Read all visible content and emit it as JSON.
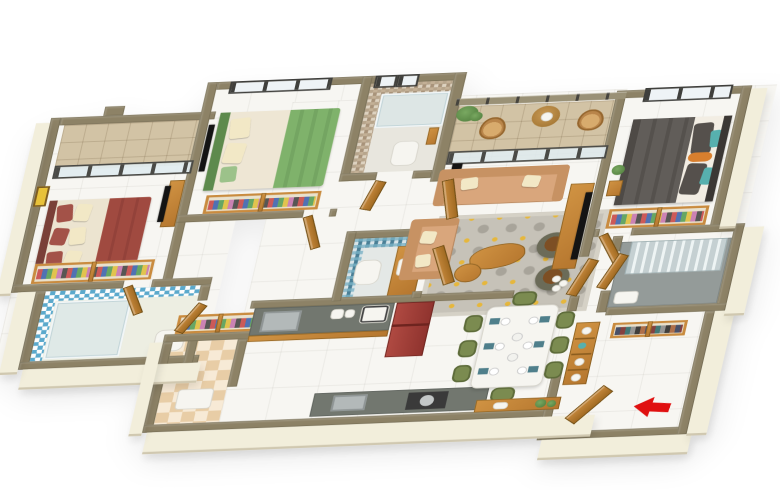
{
  "scene": {
    "type": "3d-floorplan-isometric-render",
    "description": "Photorealistic 3D rendered top-down isometric floor plan of a 3-bedroom apartment on a white background",
    "background": "#ffffff"
  },
  "palette": {
    "wall_top": "#8d8266",
    "wall_face": "#f2eedb",
    "marble": "#f7f6f2",
    "stone_tan": "#d2c3a5",
    "wood": "#c98b3f",
    "wood_dark": "#b5762e",
    "sofa_tan": "#d9a67c",
    "pillow_cream": "#f2e8c6",
    "bed1_maroon": "#a04a40",
    "bed2_green": "#7fb26b",
    "bed3_gray": "#5f5b57",
    "teal_accent": "#57b0ae",
    "orange_accent": "#d97f2e",
    "dining_chair_olive": "#7b8b50",
    "counter_gray": "#72776f",
    "fridge_red": "#8f332e",
    "tile_blue": "#5ba9cc",
    "mosaic_beige": "#c3b096",
    "mosaic_blue": "#6fa8bc",
    "rug_gray": "#c6c2b8",
    "rug_yellow": "#e6b73c",
    "glass": "#e9eff1",
    "arrow_red": "#e01010",
    "utility_tile": "#e8cda6"
  },
  "rooms": [
    {
      "name": "balcony-1",
      "floor": "stone tiles",
      "features": [
        "sliding glass door",
        "parapet walls"
      ]
    },
    {
      "name": "bedroom-1",
      "floor": "marble",
      "furniture": [
        "double bed with maroon throw",
        "maroon and cream pillows",
        "wardrobe",
        "tv unit",
        "yellow wall art"
      ]
    },
    {
      "name": "bathroom-1",
      "floor": "ceramic",
      "features": [
        "blue patterned wall tiles",
        "glass shower",
        "toilet",
        "wooden door"
      ]
    },
    {
      "name": "hallway-west",
      "floor": "marble",
      "furniture": [
        "wardrobe shoe units"
      ]
    },
    {
      "name": "bedroom-2",
      "floor": "marble",
      "furniture": [
        "double bed with green blanket",
        "green headboard",
        "wardrobe",
        "tv"
      ],
      "features": [
        "north window"
      ]
    },
    {
      "name": "bathroom-2",
      "floor": "ceramic",
      "features": [
        "beige mosaic tiles",
        "glass shower",
        "toilet",
        "two small windows"
      ]
    },
    {
      "name": "powder-toilet",
      "features": [
        "blue mosaic tiles",
        "toilet",
        "wood vanity with sink",
        "wooden door"
      ]
    },
    {
      "name": "living-room",
      "floor": "marble",
      "furniture": [
        "three-seat tan sofa",
        "two-seat tan sofa",
        "patterned gray-yellow rug",
        "two wooden coffee tables",
        "two olive poufs with wood tops",
        "tv console with vases",
        "camera tripod"
      ]
    },
    {
      "name": "living-balcony",
      "floor": "stone tiles",
      "furniture": [
        "two wicker chairs",
        "round wooden table",
        "planter"
      ],
      "features": [
        "metal railing",
        "glass sliding doors"
      ]
    },
    {
      "name": "master-bedroom",
      "floor": "marble",
      "furniture": [
        "bed with dark gray blanket",
        "gray pillows",
        "teal accent pillows",
        "orange bolster",
        "wardrobe",
        "side table with plant"
      ],
      "features": [
        "north window"
      ]
    },
    {
      "name": "master-bathroom",
      "floor": "gray ceramic",
      "features": [
        "glass shower partition",
        "white tray"
      ]
    },
    {
      "name": "kitchen",
      "furniture": [
        "gray counter with wooden cabinets",
        "sink",
        "microwave",
        "kettle",
        "red refrigerator",
        "south counter with hob and sink"
      ]
    },
    {
      "name": "utility",
      "floor": "beige checker tiles",
      "furniture": [
        "white mat"
      ]
    },
    {
      "name": "dining-area",
      "furniture": [
        "white six-seat table",
        "six olive-green chairs",
        "place settings",
        "wooden console with plants"
      ]
    },
    {
      "name": "foyer-entry",
      "furniture": [
        "tall wooden bookshelf",
        "shoe racks",
        "open wooden entry door"
      ],
      "features": [
        "red entry arrow pointing left"
      ]
    }
  ],
  "entry": {
    "arrow_color": "#e01010",
    "direction": "left"
  }
}
